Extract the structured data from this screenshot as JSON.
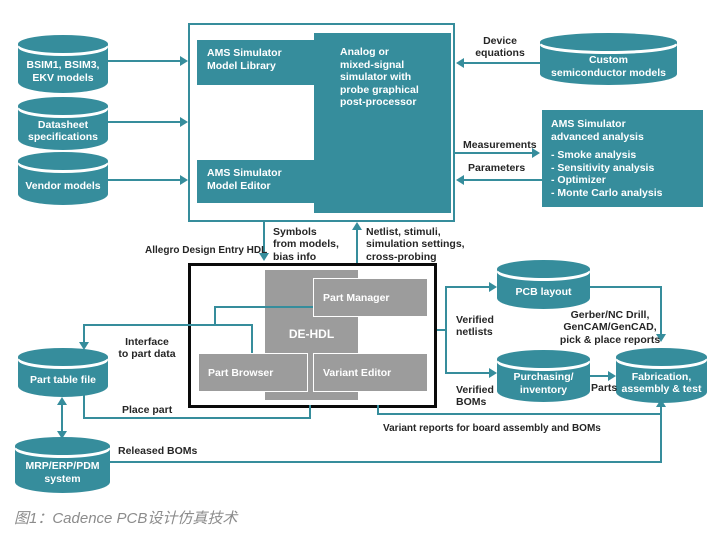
{
  "colors": {
    "teal": "#368d9c",
    "gray_box": "#9c9c9c",
    "label": "#262626",
    "caption": "#8c8c8c"
  },
  "cylinders": {
    "bsim": "BSIM1, BSIM3,\nEKV models",
    "datasheet": "Datasheet\nspecifications",
    "vendor": "Vendor models",
    "custom": "Custom\nsemiconductor models",
    "pcb_layout": "PCB layout",
    "purchasing": "Purchasing/\ninventory",
    "fabrication": "Fabrication,\nassembly & test",
    "part_table": "Part table file",
    "mrp": "MRP/ERP/PDM\nsystem"
  },
  "sim_block": {
    "model_library": "AMS Simulator\nModel Library",
    "model_editor": "AMS Simulator\nModel Editor",
    "analog_sim": "Analog or\nmixed-signal\nsimulator with\nprobe graphical\npost-processor"
  },
  "analysis_box": {
    "title": "AMS Simulator\nadvanced analysis",
    "items": "- Smoke analysis\n- Sensitivity analysis\n- Optimizer\n- Monte Carlo analysis"
  },
  "design_entry": {
    "label": "Allegro Design Entry HDL",
    "de_hdl": "DE-HDL",
    "part_manager": "Part Manager",
    "part_browser": "Part Browser",
    "variant_editor": "Variant Editor"
  },
  "flow_labels": {
    "device_equations": "Device\nequations",
    "measurements": "Measurements",
    "parameters": "Parameters",
    "symbols": "Symbols\nfrom models,\nbias info",
    "netlist": "Netlist, stimuli,\nsimulation settings,\ncross-probing",
    "interface": "Interface\nto part data",
    "place_part": "Place part",
    "verified_netlists": "Verified\nnetlists",
    "verified_boms": "Verified\nBOMs",
    "gerber": "Gerber/NC Drill,\nGenCAM/GenCAD,\npick & place reports",
    "parts": "Parts",
    "variant_reports": "Variant reports for board assembly and BOMs",
    "released_boms": "Released BOMs"
  },
  "caption": "图1：Cadence PCB设计仿真技术"
}
